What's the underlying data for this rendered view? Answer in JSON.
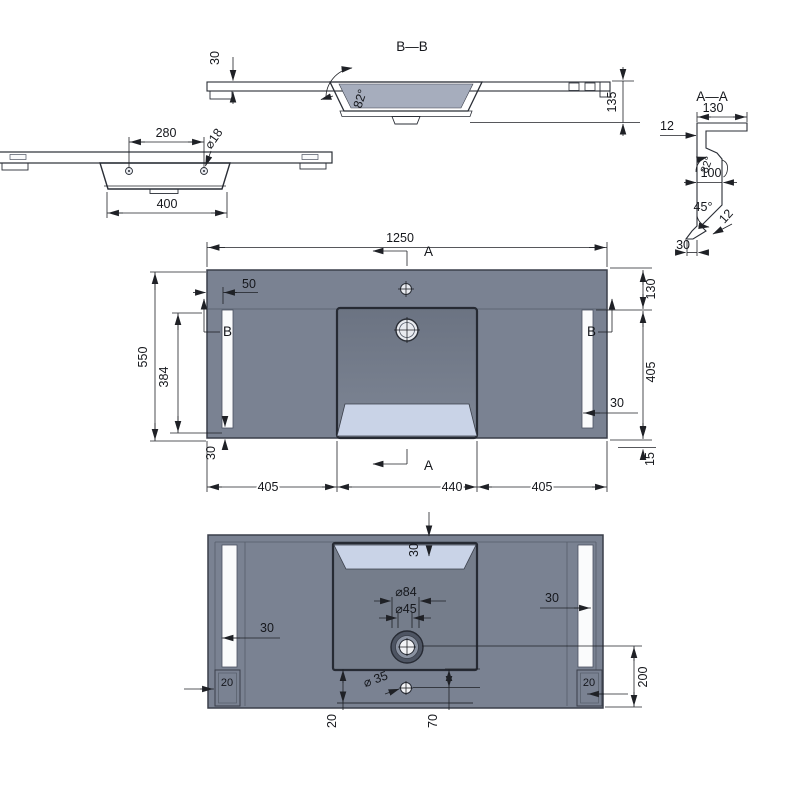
{
  "drawing_type": "basin technical drawing, five orthographic views",
  "colors": {
    "surface_gray": "#7A8292",
    "section_gray": "#8F97A7",
    "slope_highlight": "#C9D3E7",
    "slot_white": "#FAFBFC",
    "line": "#1F2126",
    "background": "#FFFFFF"
  },
  "labels": {
    "side": {
      "hole_spacing": "280",
      "hole_dia": "⌀18",
      "basin_width": "400"
    },
    "bb": {
      "title": "B—B",
      "top_thickness": "30",
      "wall_angle": "82°",
      "total_height": "135"
    },
    "aa": {
      "title": "A—A",
      "flange_width": "130",
      "flange_thickness": "12",
      "wall_angle": "82°",
      "wall_depth": "100",
      "chamfer_angle": "45°",
      "chamfer_thickness": "12",
      "base_width": "30"
    },
    "plan": {
      "overall_width": "1250",
      "overall_depth": "550",
      "sec_a_top": "A",
      "sec_a_bottom": "A",
      "sec_b_left": "B",
      "sec_b_right": "B",
      "slot_inset": "50",
      "basin_to_front": "384",
      "back_margin": "130",
      "slot_length": "405",
      "slot_width": "30",
      "front_margin": "15",
      "slot_to_edge": "30",
      "left_span": "405",
      "center_span": "440",
      "right_span": "405"
    },
    "bottom": {
      "slope_depth": "30",
      "drain_outer_dia": "⌀84",
      "drain_inner_dia": "⌀45",
      "left_slot_width": "30",
      "right_slot_width": "30",
      "left_foot_width": "20",
      "right_foot_width": "20",
      "overflow_dia": "⌀ 35",
      "overflow_offset": "20",
      "overflow_to_basin": "70",
      "drain_to_front": "200"
    }
  }
}
